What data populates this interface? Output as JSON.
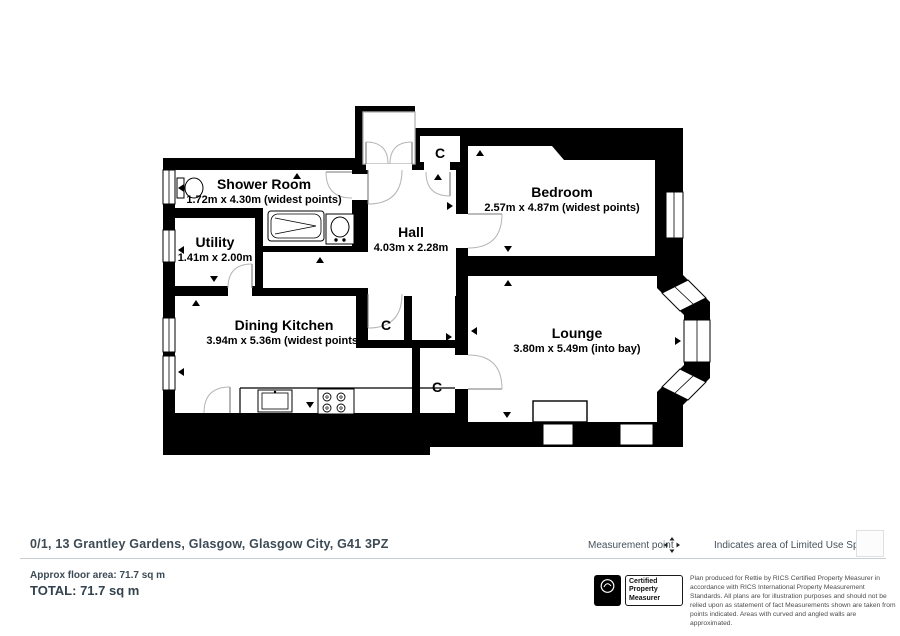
{
  "plan": {
    "rooms": [
      {
        "name": "Shower Room",
        "dims": "1.72m x 4.30m (widest points)"
      },
      {
        "name": "Utility",
        "dims": "1.41m x 2.00m"
      },
      {
        "name": "Hall",
        "dims": "4.03m x 2.28m"
      },
      {
        "name": "Bedroom",
        "dims": "2.57m x 4.87m (widest points)"
      },
      {
        "name": "Dining Kitchen",
        "dims": "3.94m x 5.36m (widest points)"
      },
      {
        "name": "Lounge",
        "dims": "3.80m x 5.49m (into bay)"
      }
    ],
    "cupboard_label": "C"
  },
  "footer": {
    "address": "0/1, 13 Grantley Gardens, Glasgow, Glasgow City, G41 3PZ",
    "approx_area": "Approx floor area: 71.7 sq m",
    "total": "TOTAL: 71.7 sq m"
  },
  "legend": {
    "measurement_point": "Measurement point",
    "limited_use": "Indicates area of Limited Use Space"
  },
  "certification": {
    "rics_label": "RICS",
    "badge": "Certified Property Measurer",
    "disclaimer": "Plan produced for Rettie by RICS Certified Property Measurer in accordance with RICS International Property Measurement Standards. All plans are for illustration purposes and should not be relied upon as statement of fact Measurements shown are taken from points indicated. Areas with curved and angled walls are approximated."
  },
  "colors": {
    "wall": "#000000",
    "text_primary": "#3c4a55",
    "divider": "#c9ced2",
    "door_arc": "#aaaaaa"
  }
}
